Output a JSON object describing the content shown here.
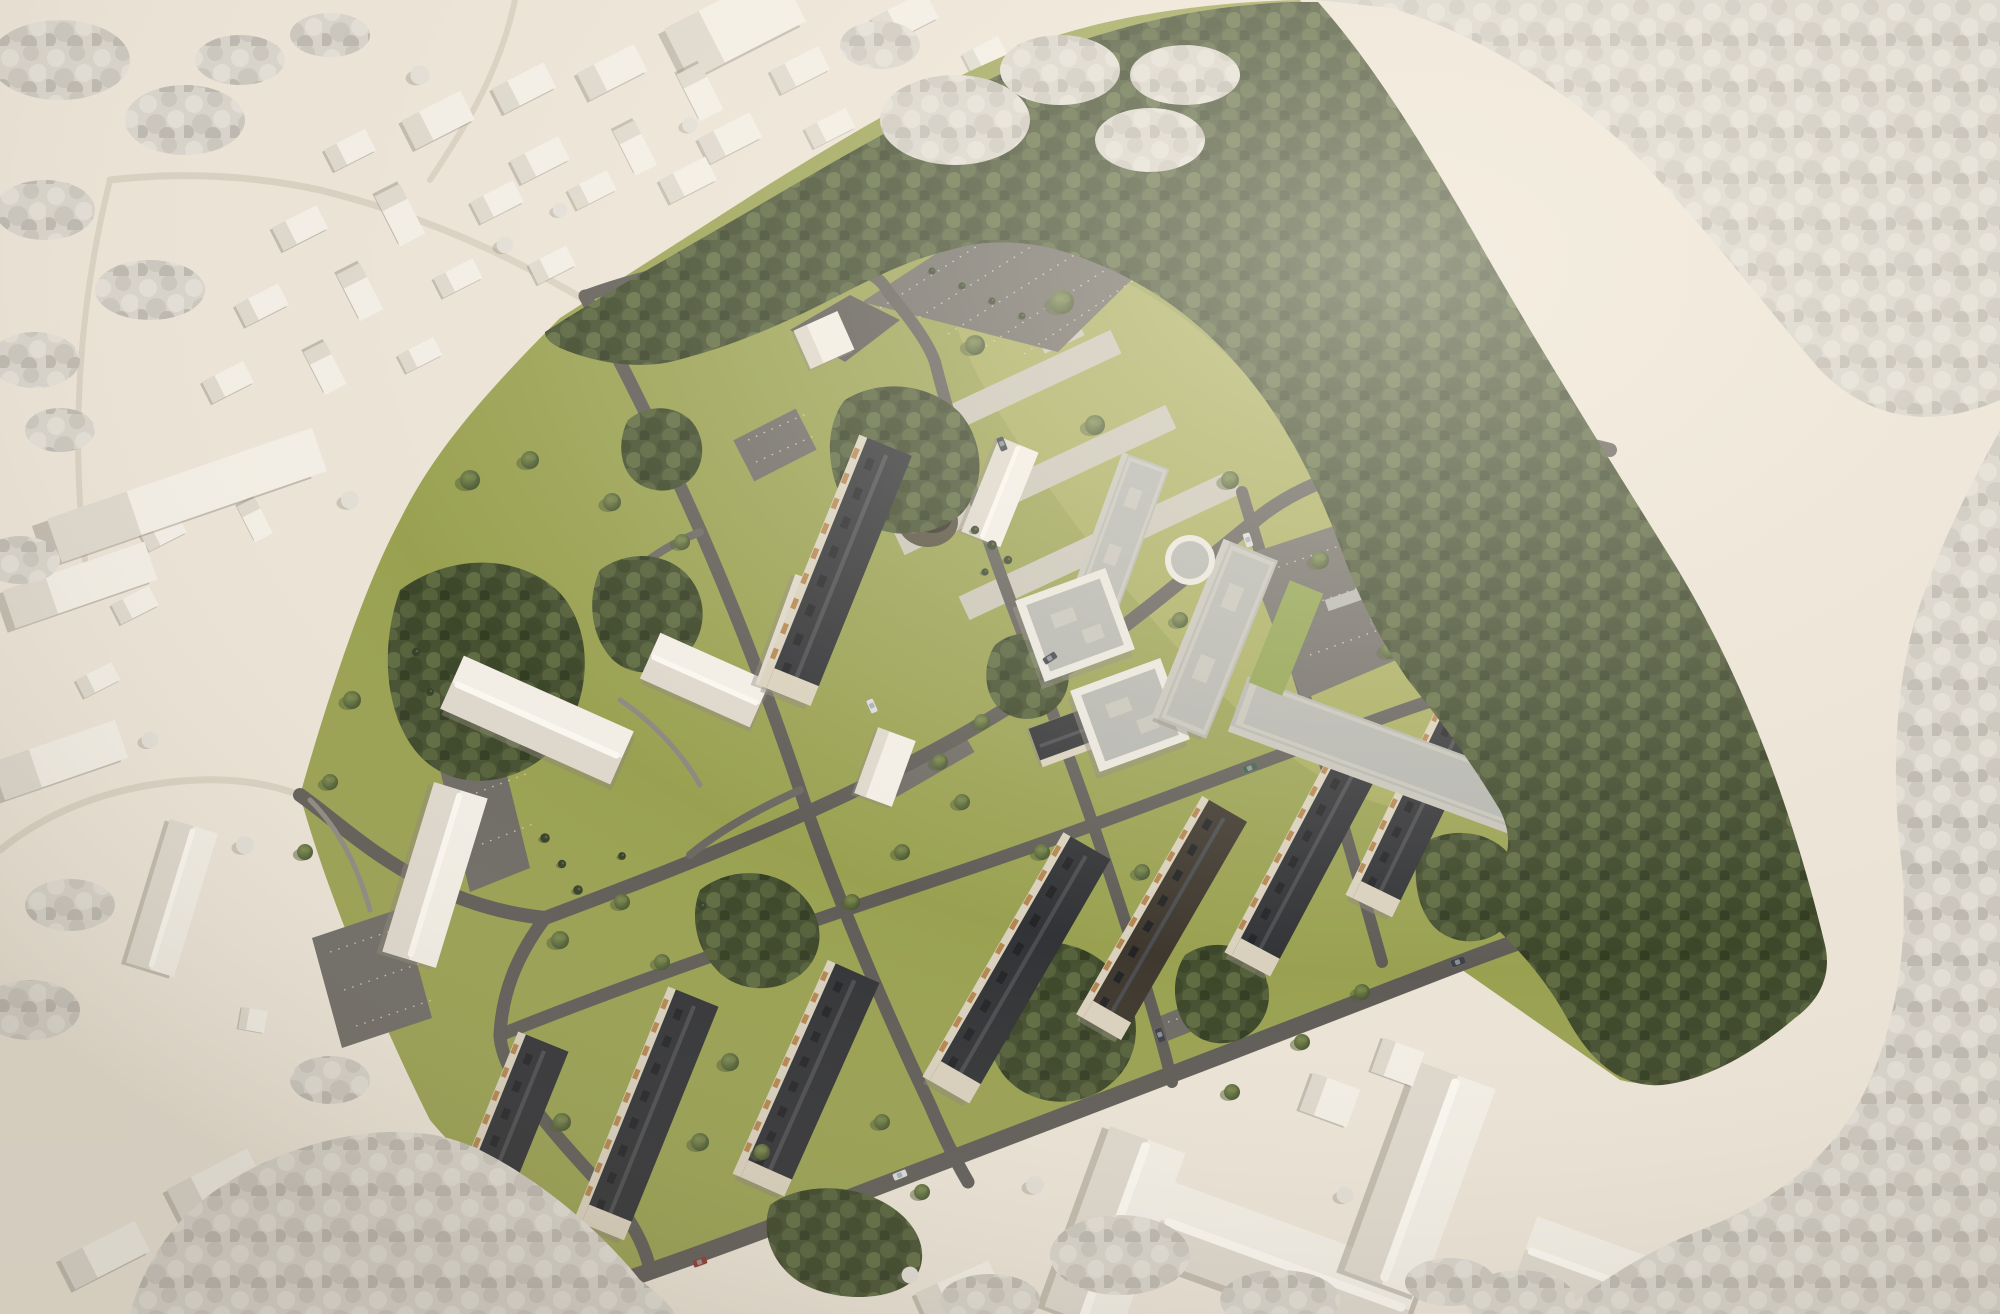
{
  "meta": {
    "title": "Aerial 3D masterplan rendering",
    "type": "architectural-visualization",
    "canvas": {
      "width": 2000,
      "height": 1314
    }
  },
  "scene": {
    "description": "Bird's-eye perspective rendering of a housing-quarter masterplan: an olive-green campus with refurbished gabled apartment blocks (dark roofs, cream facades), new white flat-roof buildings, a large U-shaped perimeter block beside a dense tree belt, lawns, parking courts, a round landscape feature and a playground. The surrounding town, big institutional buildings and outer woodland are rendered in white clay style on beige ground.",
    "time_of_day": "daylight, sun from upper right",
    "elements": [
      "white-clay-context-town",
      "white-clay-woodland",
      "site-lawn",
      "dark-forest-belt",
      "upper-meadow",
      "former-parade-ground-strips",
      "asphalt-roads",
      "parking-lots",
      "gabled-apartment-blocks",
      "modern-flat-roof-buildings",
      "u-shaped-perimeter-block",
      "retained-white-buildings",
      "round-landscape-feature",
      "playground",
      "site-trees",
      "cars"
    ],
    "approx_counts": {
      "gabled_apartment_blocks": 12,
      "modern_flat_roof_buildings": 7,
      "context_white_buildings": 40,
      "cars_visible": 10
    }
  },
  "palette": {
    "c-ground": "#ebe3d5",
    "c-groundLight": "#f4edde",
    "c-ctxRoad": "#d9d0c1",
    "c-whiteBuilding": "#f2eee5",
    "c-whiteBuildingSide": "#d7d1c5",
    "c-whiteRidge": "#faf7f0",
    "c-buildingShadow": "#8d887b",
    "c-whiteTreeBase": "#d7d3ca",
    "c-whiteTreeDot1": "#e2ded5",
    "c-whiteTreeDot2": "#cbc6bd",
    "c-whiteTreeDot3": "#bdb8af",
    "c-grass": "#99a151",
    "c-grassLight": "#a9ae5e",
    "c-grassShade": "#7f8a45",
    "c-forestBase": "#465031",
    "c-forestDot1": "#55613a",
    "c-forestDot2": "#3c4628",
    "c-forestDot3": "#5f6c41",
    "c-forestDot4": "#333d22",
    "c-road": "#5f5c57",
    "c-roadMinor": "#6b6862",
    "c-path": "#8d8880",
    "c-parking": "#6e6b65",
    "c-parkingDark": "#5a5752",
    "c-stall": "#d6d1c4",
    "c-concrete": "#c8c4b6",
    "c-roofDark": "#323336",
    "c-roofBrown": "#3f382f",
    "c-roofRidge": "#4b4c4f",
    "c-roofDormer": "#232427",
    "c-facade": "#d9d1bd",
    "c-balcony": "#b5854f",
    "c-modernWall": "#e9e6dd",
    "c-modernSide": "#c6c3b9",
    "c-modernRoof": "#b4b5af",
    "c-greenRoof": "#8da04b",
    "c-treeLight": "#7c8a4e",
    "c-treeMid": "#5c6a3c",
    "c-treeDark": "#42502c",
    "c-treeShadow": "#525e33",
    "c-coniferGreen": "#35402a",
    "c-circleFeature": "#55503f",
    "c-circleInner": "#332f26",
    "c-sand": "#dbd2b2",
    "c-carDark": "#3c4148",
    "c-carWhite": "#d8dbdc",
    "c-carRed": "#8a3b31",
    "c-carGreen": "#3d5c46"
  }
}
